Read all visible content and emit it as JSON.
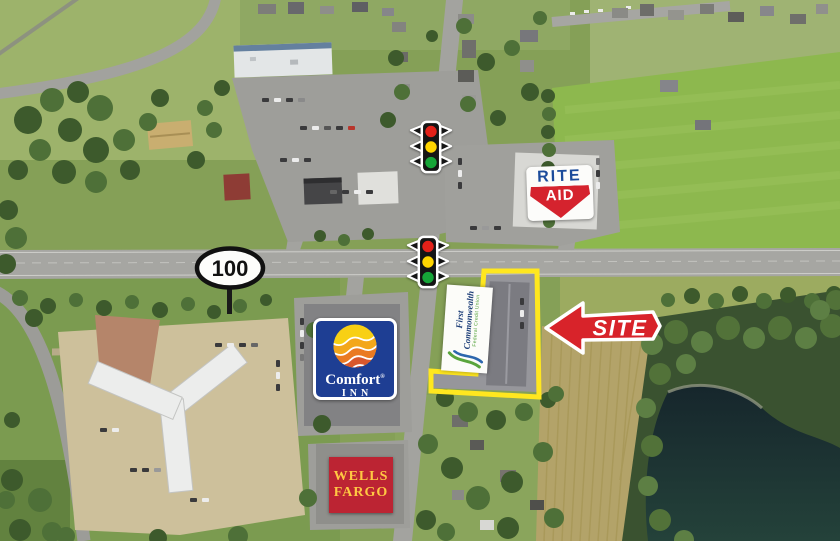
{
  "page": {
    "title": "Aerial retail site map"
  },
  "map": {
    "route_shield": {
      "number": "100"
    },
    "markers": {
      "rite_aid": {
        "line1": "RITE",
        "line2": "AID"
      },
      "comfort_inn": {
        "line1": "Comfort",
        "reg": "®",
        "line2": "INN"
      },
      "first_commonwealth": {
        "line1": "First",
        "line2": "Commonwealth",
        "tagline": "Federal Credit Union"
      },
      "wells_fargo": {
        "line1": "WELLS",
        "line2": "FARGO"
      },
      "site_arrow": {
        "label": "SITE"
      },
      "traffic_light_count": 2
    }
  },
  "colors": {
    "signal-red": "#e32119",
    "signal-yellow": "#ffd500",
    "signal-green": "#16a538",
    "riteaid-blue": "#1b4b9b",
    "riteaid-red": "#d5232e",
    "comfort-blue": "#1e3e93",
    "wellsfargo-red": "#bc2433",
    "wellsfargo-yellow": "#ffc943",
    "fc-blue": "#1d3e78",
    "fc-green": "#55a33b",
    "arrow-red": "#d8232a",
    "boundary-yellow": "#ffe71f"
  }
}
